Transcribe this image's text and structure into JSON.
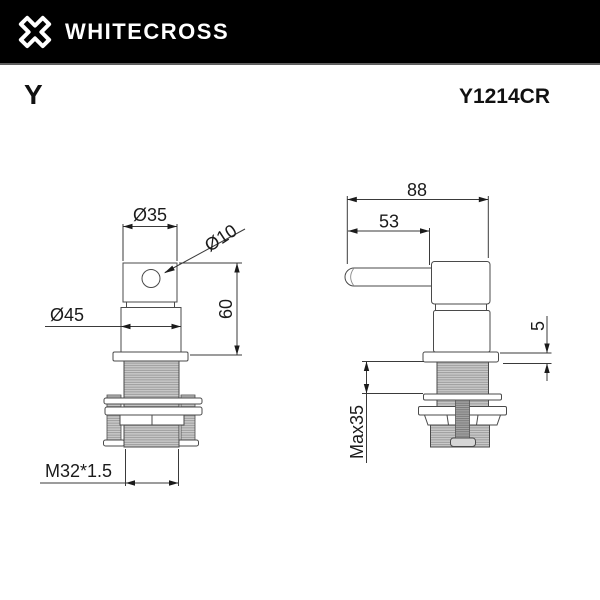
{
  "header": {
    "brand": "WHITECROSS",
    "logo_icon": "whitecross-x-logo",
    "bg_color": "#000000",
    "fg_color": "#ffffff"
  },
  "product": {
    "series": "Y",
    "model": "Y1214CR"
  },
  "drawing": {
    "type": "technical-dimension-drawing",
    "subject": "basin valve / faucet handle",
    "line_color": "#4a4a4a",
    "thread_fill": "#cbcbcb",
    "views": {
      "front": {
        "name": "front-view",
        "dimension_keys": [
          "dia35",
          "dia10",
          "dia45",
          "h60",
          "m32"
        ]
      },
      "side": {
        "name": "side-view",
        "dimension_keys": [
          "w88",
          "w53",
          "t5",
          "max35"
        ]
      }
    },
    "dims": {
      "dia35": "Ø35",
      "dia10": "Ø10",
      "dia45": "Ø45",
      "h60": "60",
      "m32": "M32*1.5",
      "w88": "88",
      "w53": "53",
      "t5": "5",
      "max35": "Max35"
    }
  }
}
